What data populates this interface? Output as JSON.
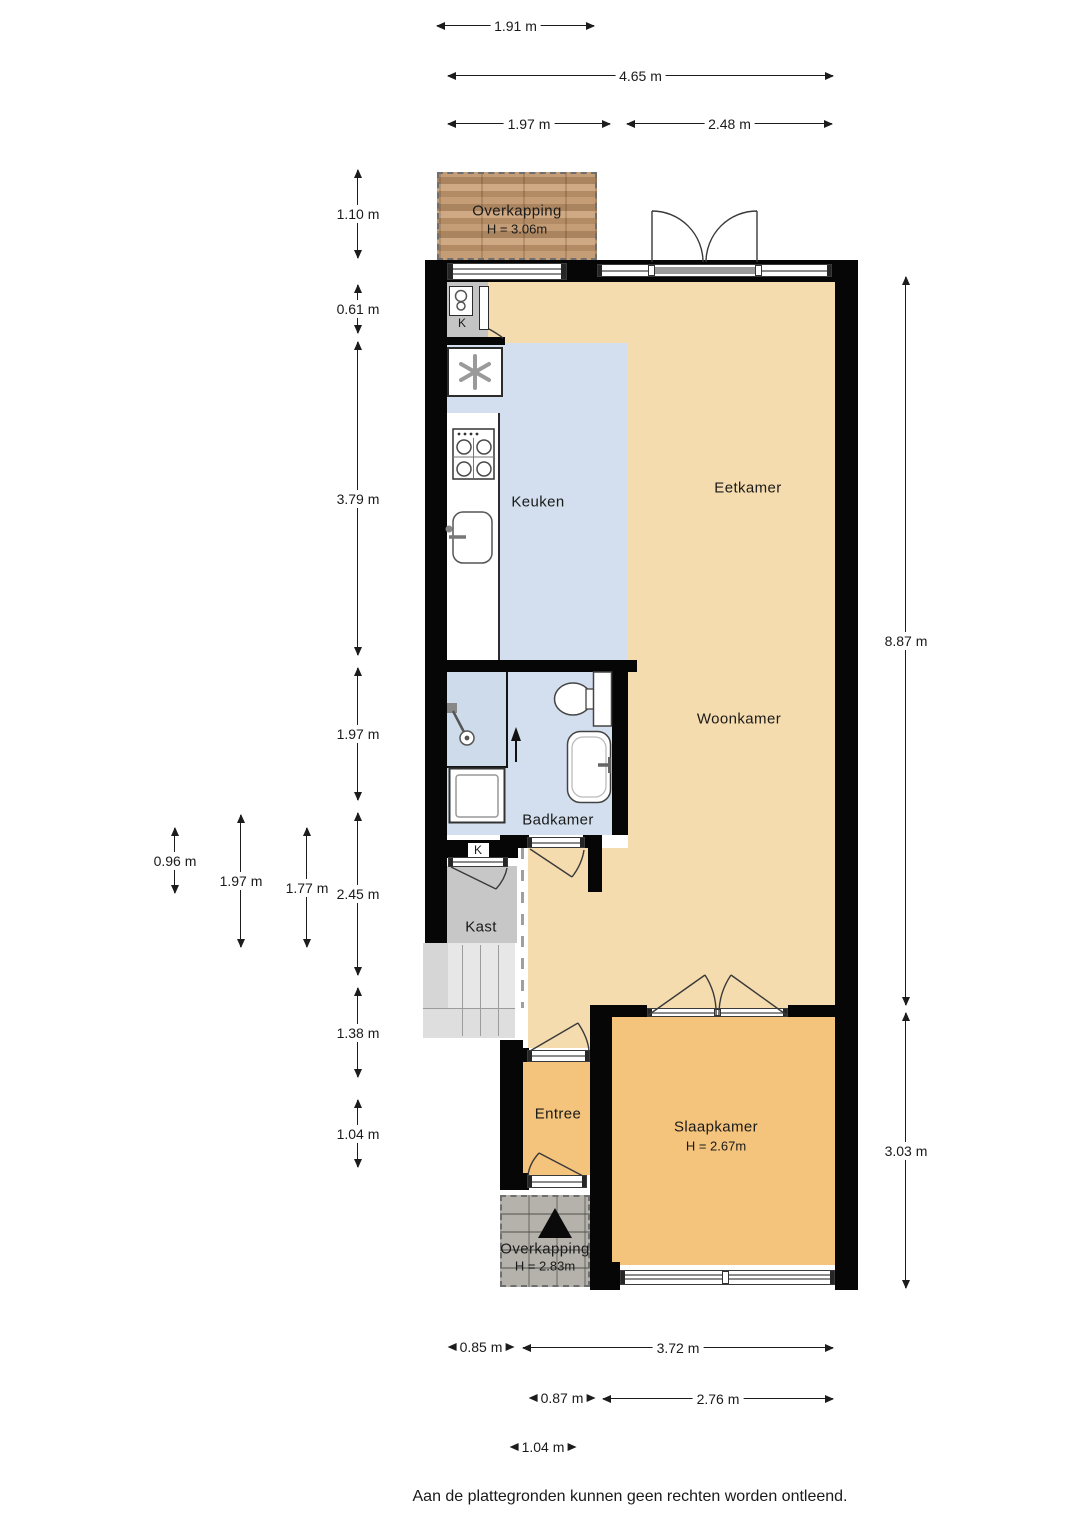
{
  "rooms": {
    "overkapping_top": {
      "name": "Overkapping",
      "height": "H = 3.06m"
    },
    "meterkast": {
      "label": "K"
    },
    "keuken": {
      "name": "Keuken"
    },
    "eetkamer": {
      "name": "Eetkamer"
    },
    "woonkamer": {
      "name": "Woonkamer"
    },
    "badkamer": {
      "name": "Badkamer"
    },
    "kast": {
      "name": "Kast",
      "door_label": "K"
    },
    "entree": {
      "name": "Entree"
    },
    "slaapkamer": {
      "name": "Slaapkamer",
      "height": "H = 2.67m"
    },
    "overkapping_bottom": {
      "name": "Overkapping",
      "height": "H = 2.83m"
    }
  },
  "dimensions": {
    "top": [
      "1.91 m",
      "4.65 m",
      "1.97 m",
      "2.48 m"
    ],
    "left": [
      "1.10 m",
      "0.61 m",
      "3.79 m",
      "1.97 m",
      "2.45 m",
      "1.38 m",
      "1.04 m",
      "0.96 m",
      "1.97 m",
      "1.77 m"
    ],
    "right": [
      "8.87 m",
      "3.03 m"
    ],
    "bottom": [
      "0.85 m",
      "3.72 m",
      "0.87 m",
      "2.76 m",
      "1.04 m"
    ]
  },
  "footer": "Aan de plattegronden kunnen geen rechten worden ontleend.",
  "icons": {
    "north_arrow": "north-triangle",
    "boiler": "boiler-icon",
    "extractor": "extractor-fan-icon",
    "stove": "stove-icon",
    "kitchen_sink": "sink-icon",
    "shower": "shower-icon",
    "washing_machine": "washing-machine-icon",
    "toilet": "toilet-icon",
    "bathroom_sink": "washbasin-icon",
    "stairs": "stairs"
  },
  "colors": {
    "wall": "#060606",
    "floor_main": "#f5dcae",
    "floor_bedroom": "#f4c37c",
    "floor_wet": "#d3dfee",
    "closet": "#c7c7c7",
    "wood": "#b99272",
    "stone": "#b5b2ab"
  }
}
